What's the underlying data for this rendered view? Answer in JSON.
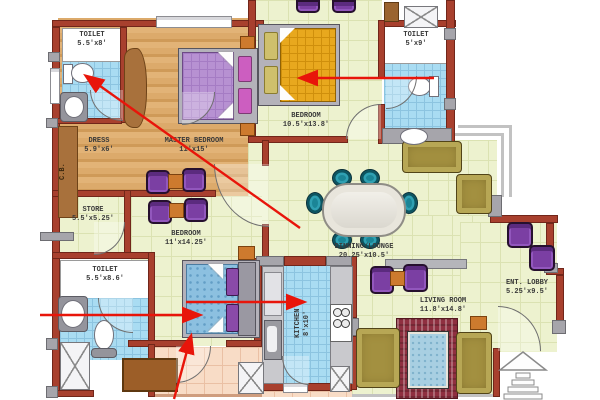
{
  "plan": {
    "type": "apartment-floor-plan",
    "rooms": [
      {
        "name": "TOILET",
        "size": "5.5'x8'"
      },
      {
        "name": "DRESS",
        "size": "5.9'x6'"
      },
      {
        "name": "MASTER BEDROOM",
        "size": "11'x15'"
      },
      {
        "name": "BEDROOM",
        "size": "10.5'x13.8'"
      },
      {
        "name": "TOILET",
        "size": "5'x9'"
      },
      {
        "name": "STORE",
        "size": "5.5'x5.25'"
      },
      {
        "name": "BEDROOM",
        "size": "11'x14.25'"
      },
      {
        "name": "DINNING/LOUNGE",
        "size": "20.25'x10.5'"
      },
      {
        "name": "TOILET",
        "size": "5.5'x8.6'"
      },
      {
        "name": "KITCHEN",
        "size": "8'x10'"
      },
      {
        "name": "LIVING ROOM",
        "size": "11.8'x14.8'"
      },
      {
        "name": "ENT. LOBBY",
        "size": "5.25'x9.5'"
      }
    ],
    "labels": {
      "cupboard": "C.B."
    },
    "colors": {
      "wall_brick": "#a8402e",
      "wall_column_gray": "#a6a5ab",
      "floor_wood": "#d9a465",
      "floor_green": "#edf2cf",
      "floor_tile_blue": "#a9dcf2",
      "floor_balcony_peach": "#f8dcc6",
      "annotation_arrow_red": "#e8150a",
      "furniture_purple": "#7b3fa3",
      "furniture_teal": "#1b8596",
      "furniture_olive": "#a39040"
    }
  }
}
